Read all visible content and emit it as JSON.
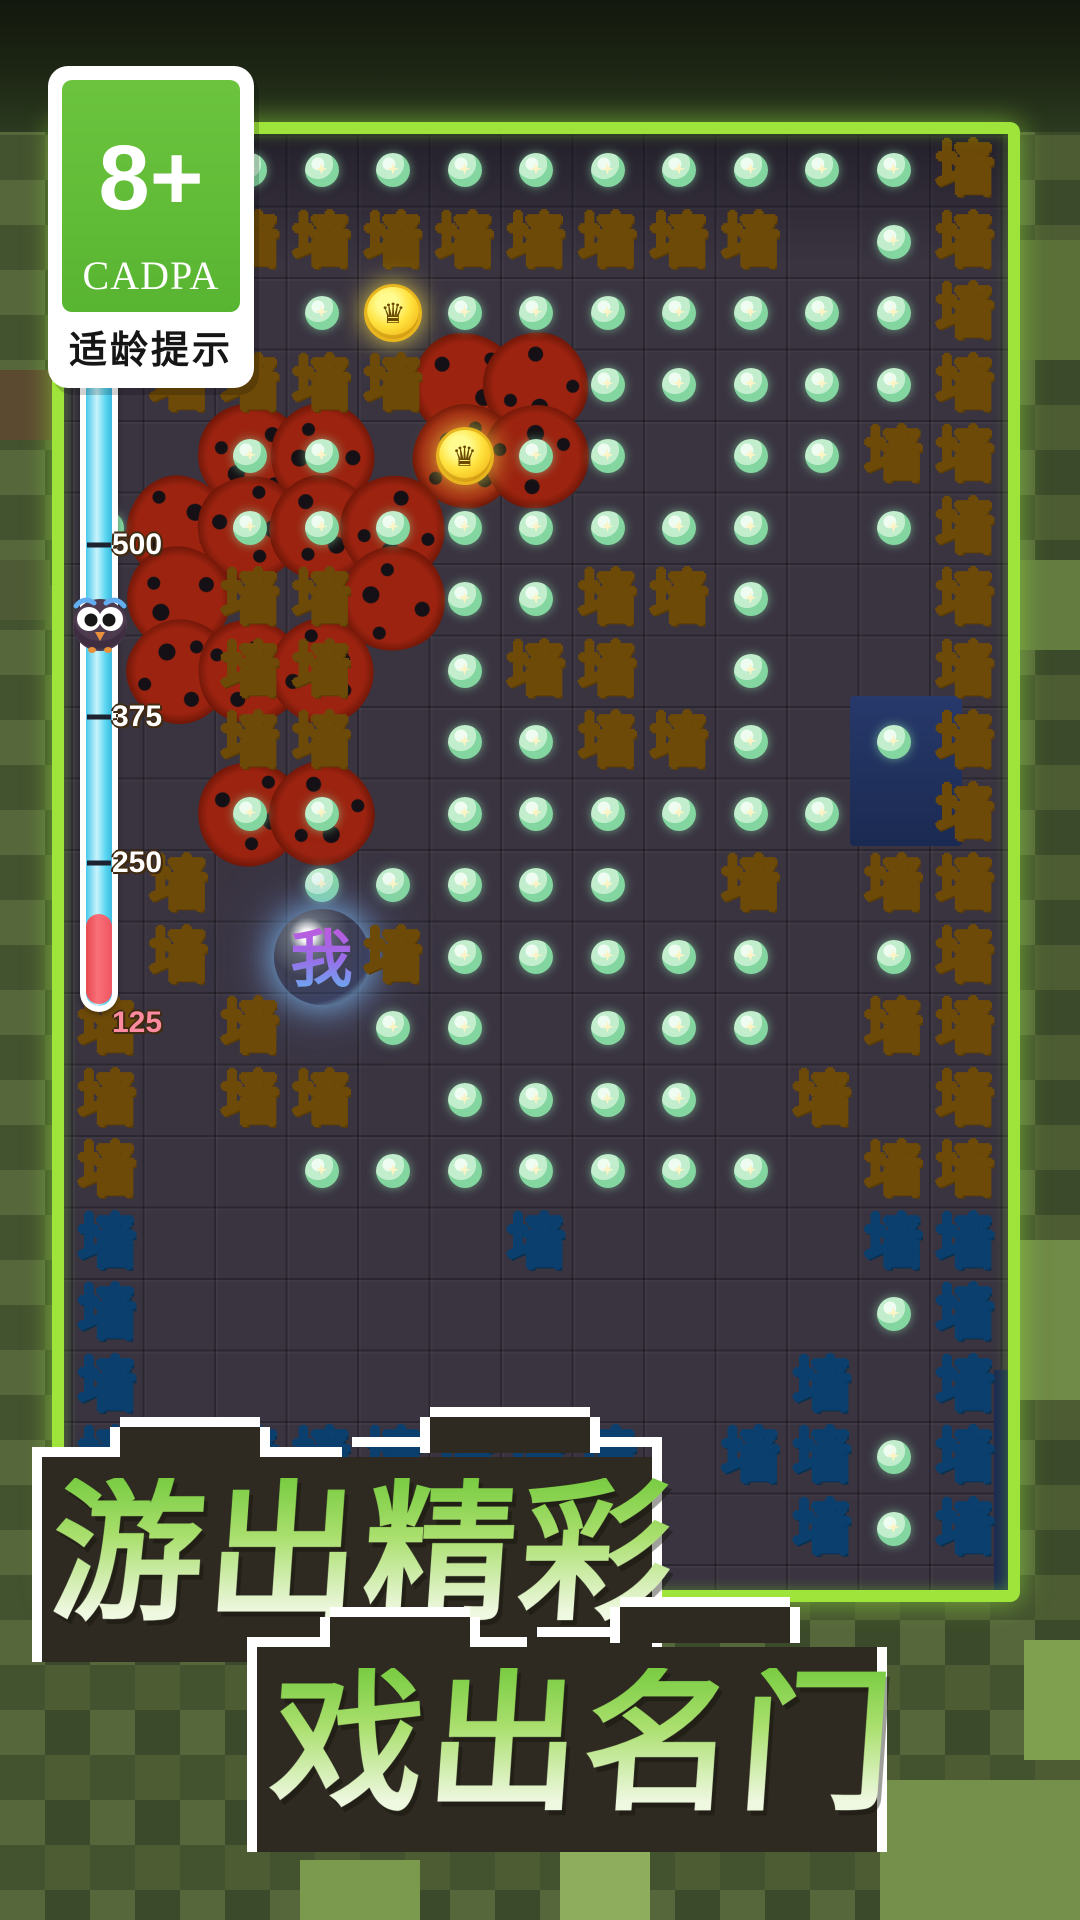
{
  "badge": {
    "rating": "8+",
    "org": "CADPA",
    "caption": "适龄提示"
  },
  "meter": {
    "ticks": [
      {
        "label": "500",
        "y": 545,
        "accent": false
      },
      {
        "label": "375",
        "y": 717,
        "accent": false
      },
      {
        "label": "250",
        "y": 863,
        "accent": false
      },
      {
        "label": "125",
        "y": 1023,
        "accent": true
      }
    ]
  },
  "board": {
    "wall_char": "墙",
    "player_char": "我",
    "coin_icon": "crown-coin",
    "pearl_icon": "star-pearl",
    "rows": [
      "..ddddddddddW",
      "..WWWWWWWW.dW",
      "...dCdddddddW",
      ".WWWW..dddddW",
      "..dd.Cdd.ddWW",
      "d.dddddddd.dW",
      "..WW.ddWWd..W",
      "..WW.dWW.d..W",
      "..WW.ddWWd.dW",
      "..dd.dddddd.W",
      ".W.ddddd.W.WW",
      ".W.PWddddd.dW",
      "W.W.dd.ddd.WW",
      "W.WW.dddd.W.W",
      "W..ddddddd.WW",
      "B.....B....BB",
      "B..........dB",
      "B.........B.B",
      "BBBBBBBB.BBdB",
      "..........BdB"
    ],
    "webs": [
      [
        3,
        5
      ],
      [
        3,
        6
      ],
      [
        4,
        2
      ],
      [
        4,
        3
      ],
      [
        4,
        5
      ],
      [
        4,
        6
      ],
      [
        5,
        1
      ],
      [
        5,
        2
      ],
      [
        5,
        3
      ],
      [
        5,
        4
      ],
      [
        6,
        1
      ],
      [
        6,
        4
      ],
      [
        7,
        1
      ],
      [
        7,
        2
      ],
      [
        7,
        3
      ],
      [
        9,
        2
      ],
      [
        9,
        3
      ]
    ]
  },
  "title": {
    "line1": "游出精彩",
    "line2": "戏出名门"
  },
  "colors": {
    "wall_gold": "#f7bc3c",
    "wall_blue": "#2ba3ea",
    "border_green": "#9fe43a",
    "meter_fill": "#5ad7f2",
    "meter_red": "#ef5560",
    "coin": "#ffe23e",
    "pearl": "#84d6a0",
    "web_red": "#9c2310",
    "navy_block": "#1b2a52",
    "title_green": "#a9df6d"
  }
}
